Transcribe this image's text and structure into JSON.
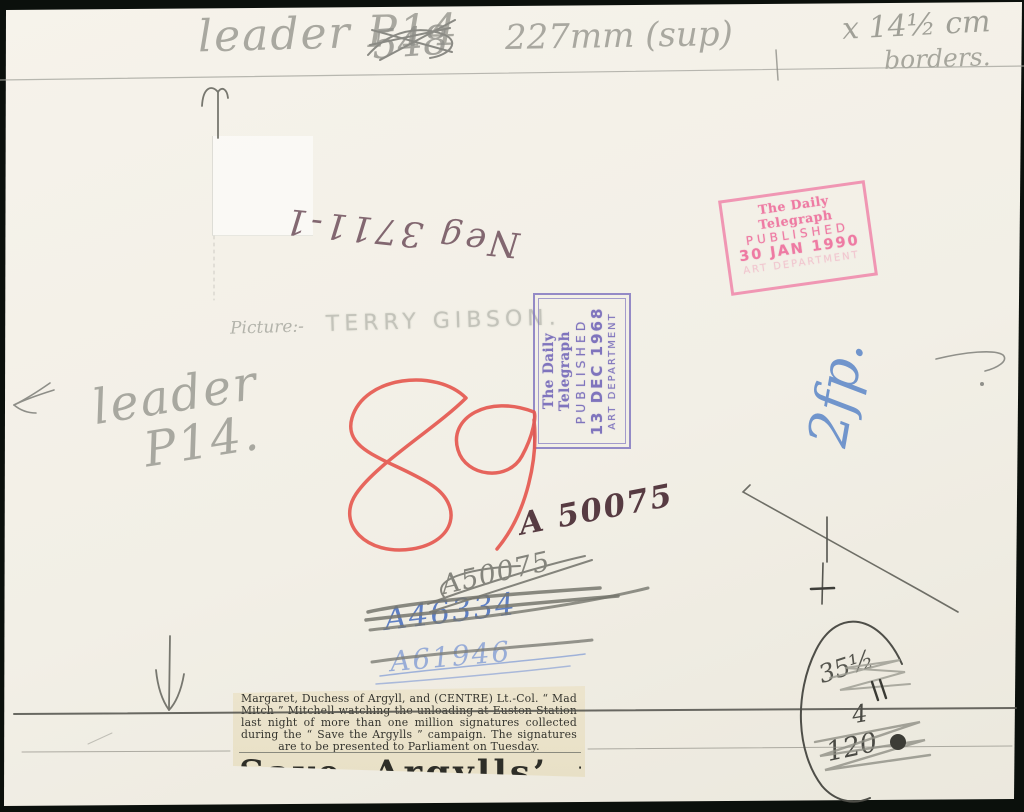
{
  "colors": {
    "background": "#0b100c",
    "paper": "#f3f0e7",
    "clipping_paper": "#e9e1c8",
    "pencil": "#9a9a92",
    "red_crayon": "#e5564e",
    "blue_ink": "#5b86c8",
    "maroon_ink": "#573b42",
    "purple_stamp": "#8278c0",
    "pink_stamp": "#ef7fa6"
  },
  "annotations": {
    "top_note": {
      "segment1": "leader P14",
      "crossed_out": "548",
      "segment2": "227mm (sup)",
      "segment3": "x 14½ cm",
      "segment4": "borders."
    },
    "neg_number": "Neg 3711-1",
    "picture_credit": {
      "label": "Picture:-",
      "name": "TERRY GIBSON."
    },
    "leader_note": {
      "line1": "leader",
      "line2": "P14."
    },
    "red_number": "89",
    "ref_number": "A 50075",
    "crossed_refs": [
      "A50075",
      "A46334",
      "A61946"
    ],
    "blue_note": "2fp.",
    "corner_scribbles": {
      "a": "35½",
      "b": "4",
      "c": "120"
    }
  },
  "stamps": {
    "purple": {
      "paper": "The Daily Telegraph",
      "published": "PUBLISHED",
      "date": "13 DEC 1968",
      "department": "ART DEPARTMENT",
      "color": "#8278c0"
    },
    "pink": {
      "paper": "The Daily Telegraph",
      "published": "PUBLISHED",
      "date": "30 JAN 1990",
      "department": "ART DEPARTMENT",
      "color": "#ef7fa6"
    }
  },
  "clipping": {
    "caption": "Margaret, Duchess of Argyll, and (CENTRE) Lt.-Col. “ Mad Mitch ” Mitchell watching the unloading at Euston Station last night of more than one million signatures collected during the “ Save the Argylls ” campaign.  The signatures are to be presented to Parliament on Tuesday.",
    "headline": "Save Argylls’ petition"
  }
}
